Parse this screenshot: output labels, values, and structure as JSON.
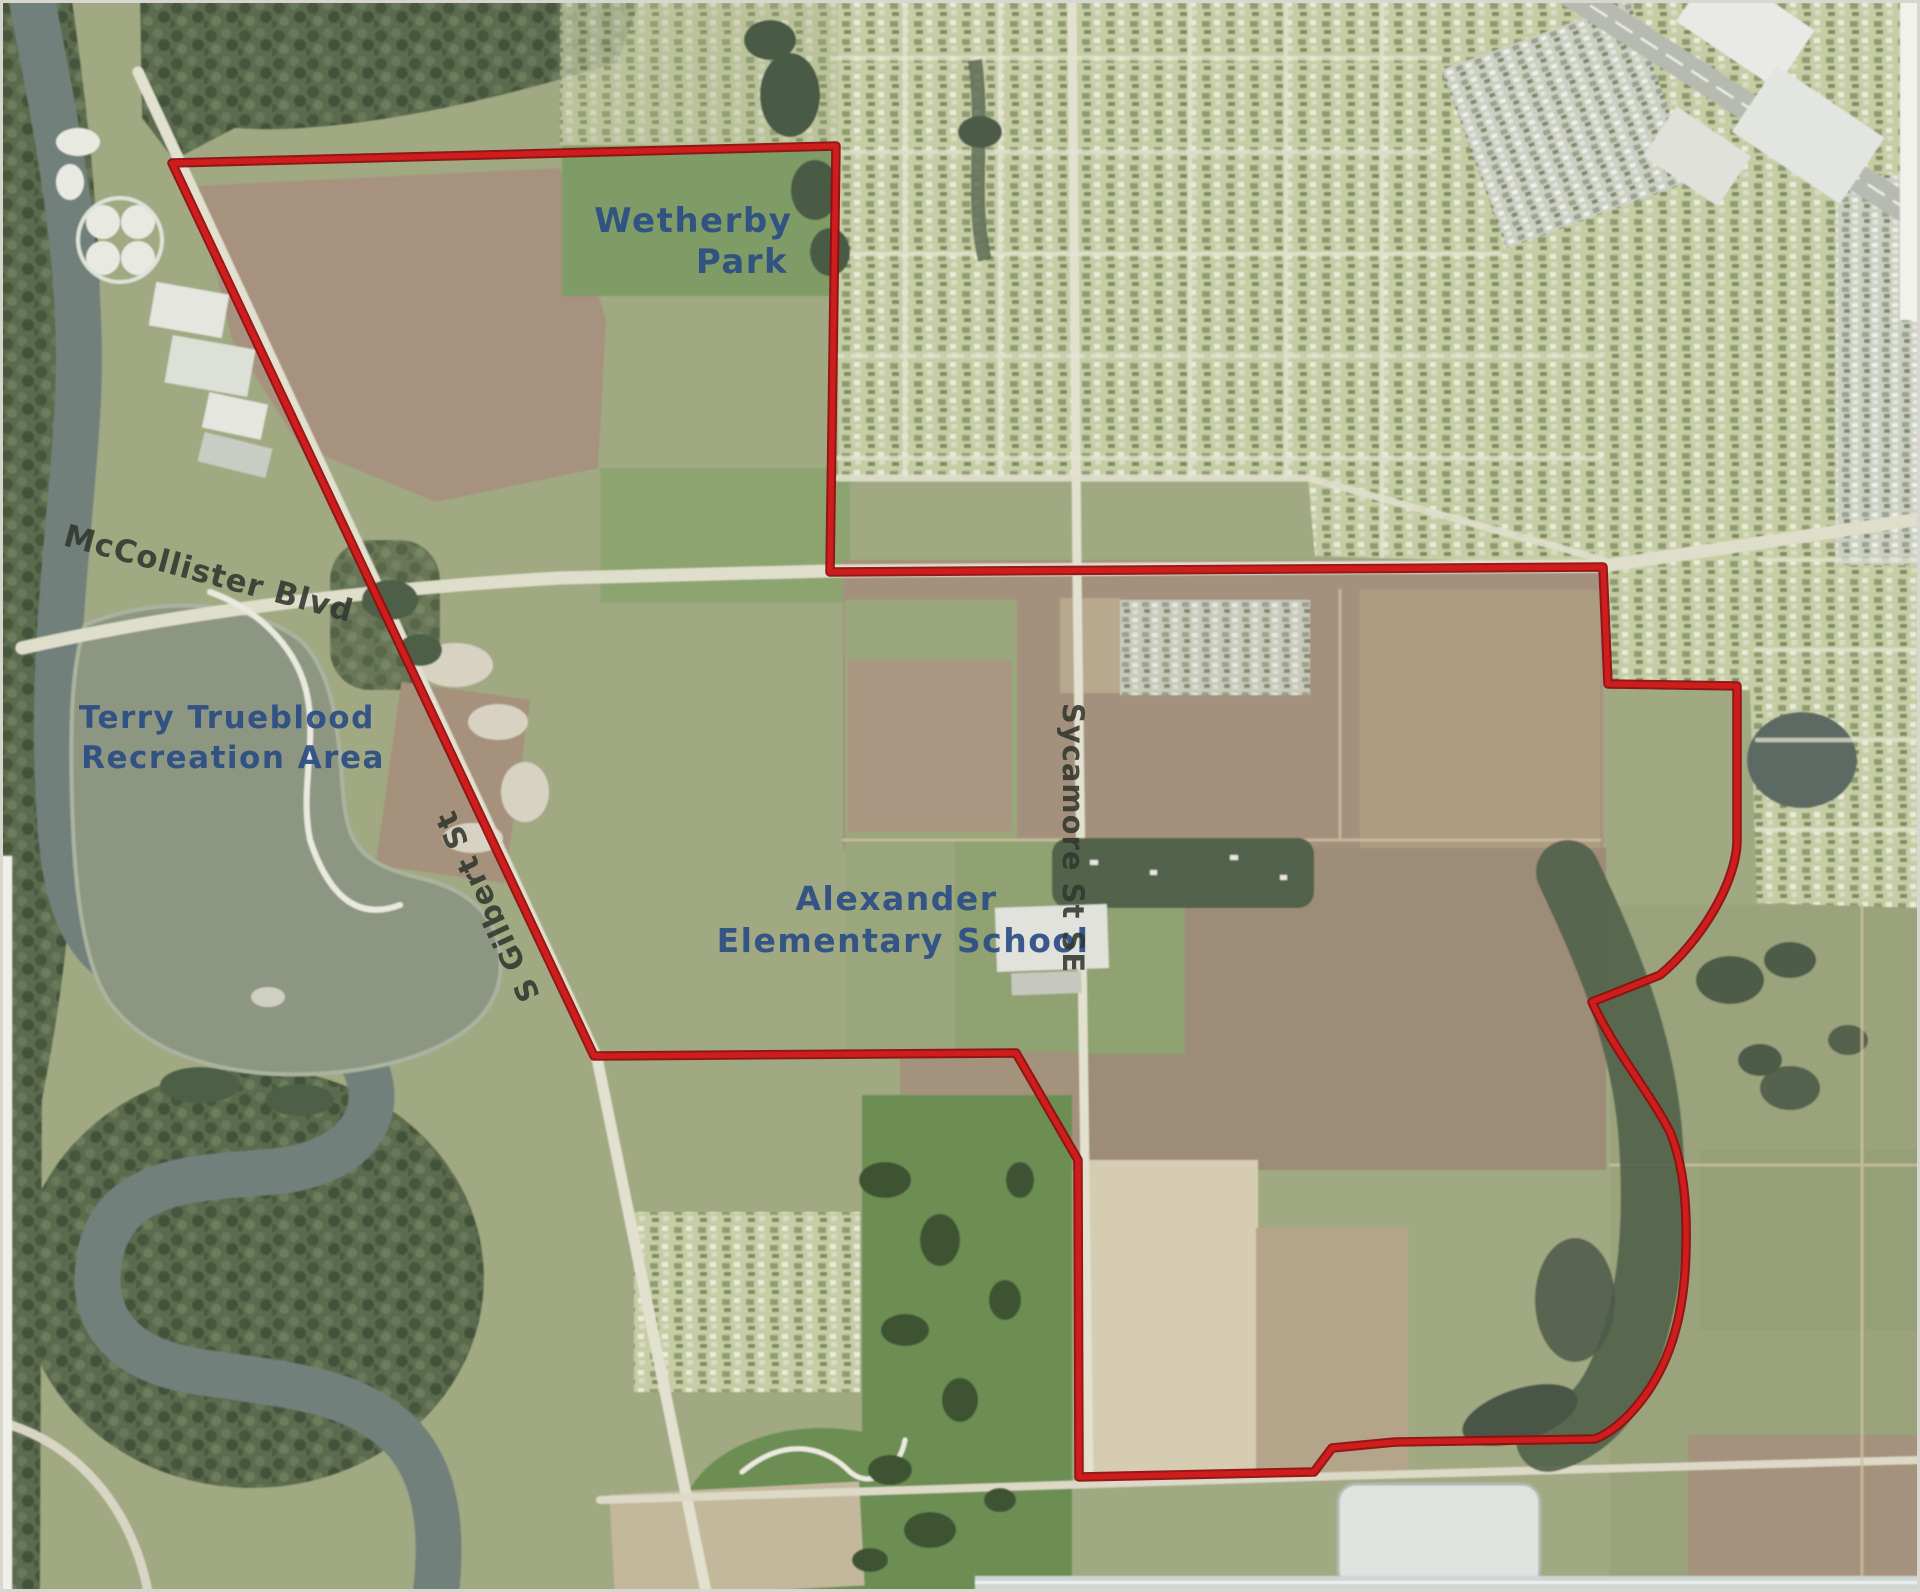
{
  "map": {
    "type": "aerial-imagery-map",
    "labels": {
      "wetherby_park": {
        "line1": "Wetherby",
        "line2": "Park"
      },
      "mccollister_blvd": "McCollister Blvd",
      "terry_trueblood": {
        "line1": "Terry Trueblood",
        "line2": "Recreation Area"
      },
      "s_gilbert_st": "S Gilbert St",
      "alexander_school": {
        "line1": "Alexander",
        "line2": "Elementary School"
      },
      "sycamore_st": "Sycamore St SE"
    },
    "colors": {
      "boundary_red": "#cf1d1d",
      "boundary_red_dark": "#8e1010",
      "label_blue": "#2b4d85",
      "label_road_dark": "#32372e",
      "water_river": "#72807b",
      "water_lake": "#8d9680",
      "field_brown": "#a4917d",
      "field_pale": "#d6ccb2",
      "residential_base": "#c6cca4",
      "woods_green": "#5b6b4d",
      "golf_green": "#6c8e53"
    }
  }
}
